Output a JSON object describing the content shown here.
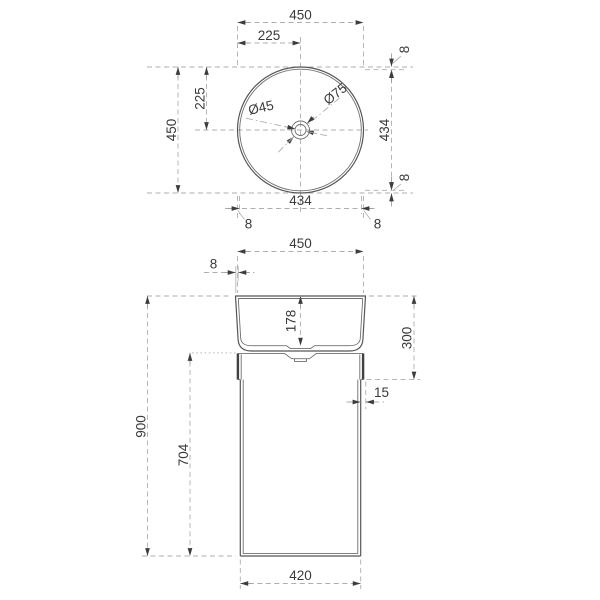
{
  "drawing": {
    "product": "round-pedestal-washbasin-dimension-drawing",
    "colors": {
      "background": "#ffffff",
      "object_line": "#565656",
      "heavy_line": "#414141",
      "dimension_line": "#aeaeae",
      "text_ink": "#3a3a3a"
    },
    "top_view": {
      "overall_width": "450",
      "center_offset_x": "225",
      "overall_depth": "450",
      "center_offset_y": "225",
      "inner_width": "434",
      "inner_depth": "434",
      "rim_gap_top": "8",
      "rim_gap_bottom": "8",
      "rim_gap_left": "8",
      "rim_gap_right": "8",
      "drain_inner_diameter": "Ø45",
      "drain_outer_diameter": "Ø75"
    },
    "front_view": {
      "top_width": "450",
      "rim_thickness": "8",
      "bowl_depth": "178",
      "basin_section_height": "300",
      "total_height": "900",
      "pedestal_height": "704",
      "side_inset": "15",
      "base_width": "420"
    }
  }
}
